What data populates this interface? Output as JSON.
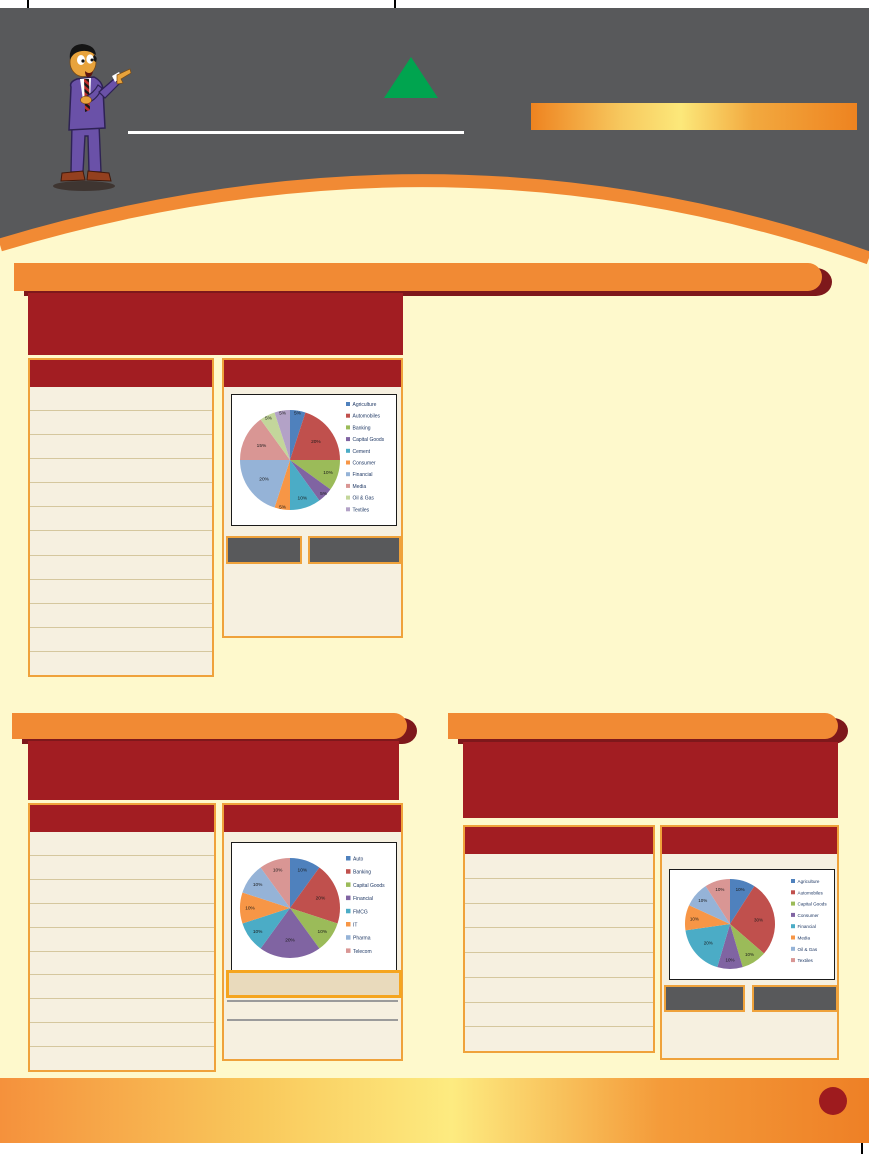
{
  "palette": {
    "header_gray": "#58595B",
    "orange": "#F18A34",
    "dark_red": "#A21D22",
    "crescent_red": "#7E181B",
    "page_yellow": "#FEF9CC",
    "panel_beige": "#F6F0E0",
    "gold_border": "#EFA23B",
    "row_line": "#D5C79E",
    "gray_box": "#58595B",
    "highlight_row": "#E9DABC",
    "footer_circle": "#9E1B1E",
    "triangle_green": "#00A44F"
  },
  "header": {
    "illustration": "presenter-cartoon-man-pointing",
    "decorations": [
      "green-up-triangle",
      "white-underline",
      "orange-gradient-bar",
      "orange-arc"
    ]
  },
  "sections": [
    {
      "name": "section-1",
      "table_rows": 12,
      "chart_index": 0,
      "info_boxes": 2
    },
    {
      "name": "section-2",
      "table_rows": 10,
      "chart_index": 1,
      "info_boxes": 0
    },
    {
      "name": "section-3",
      "table_rows": 8,
      "chart_index": 2,
      "info_boxes": 2
    }
  ],
  "chart_data": [
    {
      "type": "pie",
      "legend_position": "right",
      "categories": [
        "Agriculture",
        "Automobiles",
        "Banking",
        "Capital Goods",
        "Cement",
        "Consumer",
        "Financial",
        "Media",
        "Oil & Gas",
        "Textiles"
      ],
      "values": [
        5,
        20,
        10,
        5,
        10,
        5,
        20,
        15,
        5,
        5
      ],
      "labels": [
        "5%",
        "20%",
        "10%",
        "5%",
        "10%",
        "5%",
        "20%",
        "15%",
        "5%",
        "5%"
      ],
      "colors": [
        "#4F81BD",
        "#C0504D",
        "#9BBB59",
        "#8064A2",
        "#4BACC6",
        "#F79646",
        "#95B3D7",
        "#D99694",
        "#C3D69B",
        "#B3A2C7"
      ]
    },
    {
      "type": "pie",
      "legend_position": "right",
      "categories": [
        "Auto",
        "Banking",
        "Capital Goods",
        "Financial",
        "FMCG",
        "IT",
        "Pharma",
        "Telecom"
      ],
      "values": [
        10,
        20,
        10,
        20,
        10,
        10,
        10,
        10
      ],
      "labels": [
        "10%",
        "20%",
        "10%",
        "20%",
        "10%",
        "10%",
        "10%",
        "10%"
      ],
      "colors": [
        "#4F81BD",
        "#C0504D",
        "#9BBB59",
        "#8064A2",
        "#4BACC6",
        "#F79646",
        "#95B3D7",
        "#D99694"
      ]
    },
    {
      "type": "pie",
      "legend_position": "right",
      "categories": [
        "Agriculture",
        "Automobiles",
        "Capital Goods",
        "Consumer",
        "Financial",
        "Media",
        "Oil & Gas",
        "Textiles"
      ],
      "values": [
        10,
        30,
        10,
        10,
        20,
        10,
        10,
        10
      ],
      "labels": [
        "10%",
        "30%",
        "10%",
        "10%",
        "20%",
        "10%",
        "10%",
        "10%"
      ],
      "colors": [
        "#4F81BD",
        "#C0504D",
        "#9BBB59",
        "#8064A2",
        "#4BACC6",
        "#F79646",
        "#95B3D7",
        "#D99694"
      ]
    }
  ]
}
